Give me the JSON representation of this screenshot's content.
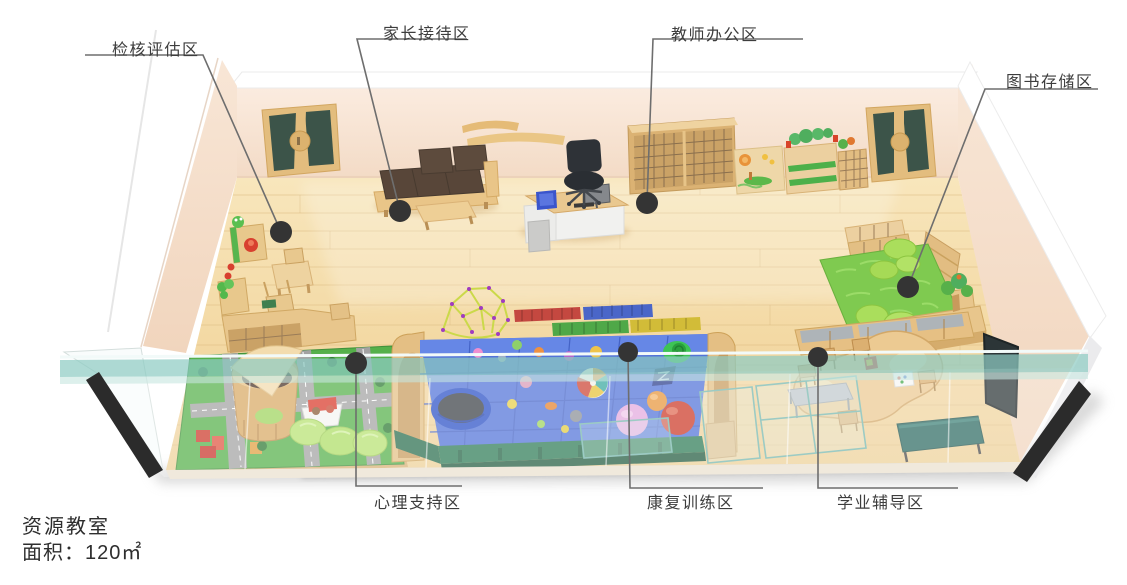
{
  "diagram": {
    "type": "isometric-floor-plan",
    "zones": [
      {
        "id": "assessment",
        "label": "检核评估区"
      },
      {
        "id": "parent-reception",
        "label": "家长接待区"
      },
      {
        "id": "teacher-office",
        "label": "教师办公区"
      },
      {
        "id": "book-storage",
        "label": "图书存储区"
      },
      {
        "id": "psychological-support",
        "label": "心理支持区"
      },
      {
        "id": "rehab-training",
        "label": "康复训练区"
      },
      {
        "id": "academic-tutoring",
        "label": "学业辅导区"
      }
    ],
    "caption": {
      "title": "资源教室",
      "area": "面积：120㎡"
    },
    "colors": {
      "wall_pink": "#f6e2d0",
      "floor_wood": "#f3d9a4",
      "door_green": "#3c5449",
      "glass_teal": "#8fccc3",
      "ball_pit_blue": "#5273d8",
      "rug_green": "#7fca50",
      "carpet_green": "#55b04a",
      "sofa_brown": "#584639",
      "label_line": "#6e6e6e",
      "label_dot": "#343434",
      "label_text": "#3d3d3d"
    }
  }
}
